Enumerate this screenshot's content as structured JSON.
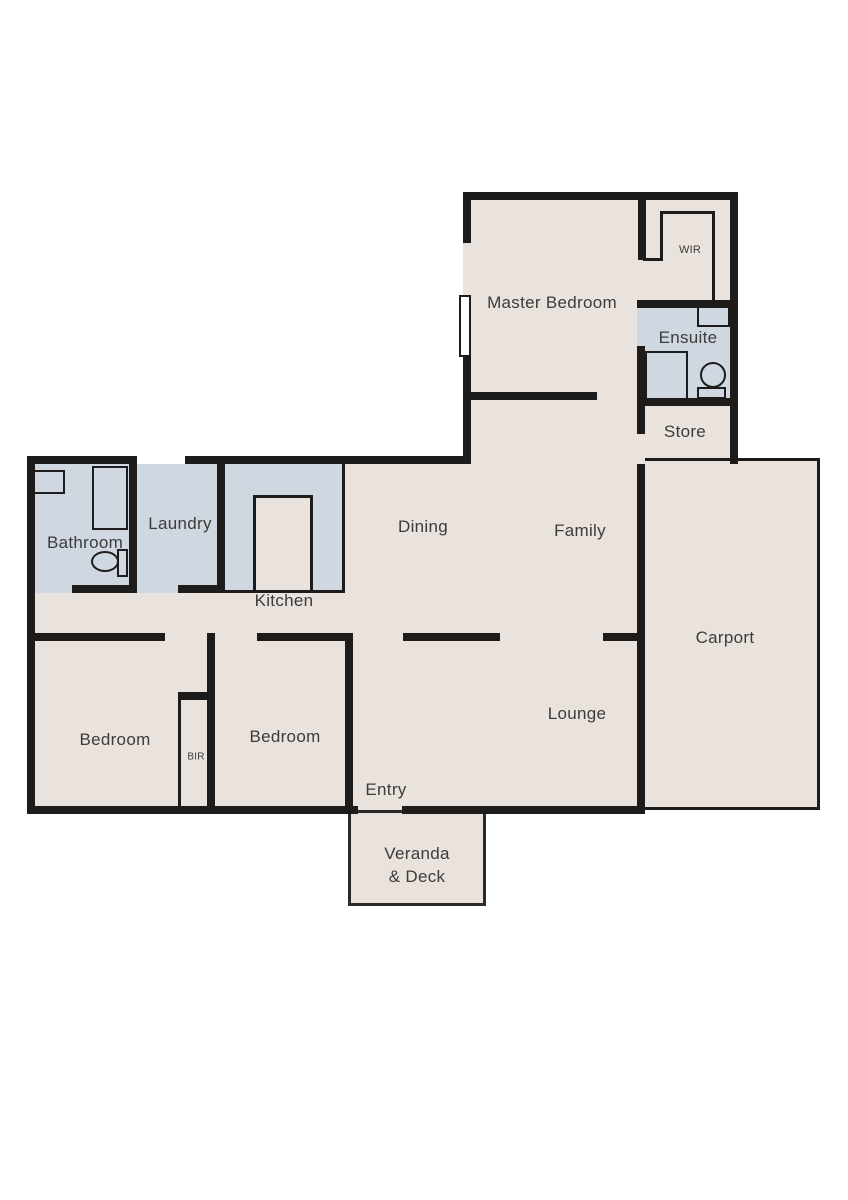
{
  "document": {
    "type": "floor-plan"
  },
  "colors": {
    "background": "#ffffff",
    "floor_fill": "#e9e2dd",
    "wet_area_fill": "#cfd7e0",
    "wall": "#1d1c1a",
    "label_text": "#3c3c3a"
  },
  "rooms": {
    "master_bedroom": {
      "label": "Master Bedroom"
    },
    "wir": {
      "label": "WIR"
    },
    "ensuite": {
      "label": "Ensuite"
    },
    "store": {
      "label": "Store"
    },
    "bathroom": {
      "label": "Bathroom"
    },
    "laundry": {
      "label": "Laundry"
    },
    "kitchen": {
      "label": "Kitchen"
    },
    "dining": {
      "label": "Dining"
    },
    "family": {
      "label": "Family"
    },
    "carport": {
      "label": "Carport"
    },
    "bedroom_left": {
      "label": "Bedroom"
    },
    "bir": {
      "label": "BIR"
    },
    "bedroom_right": {
      "label": "Bedroom"
    },
    "entry": {
      "label": "Entry"
    },
    "lounge": {
      "label": "Lounge"
    },
    "veranda": {
      "label_line1": "Veranda",
      "label_line2": "& Deck"
    }
  },
  "fixtures": [
    "toilet",
    "toilet",
    "bathtub",
    "shower",
    "basin",
    "vanity",
    "window",
    "built-in-robe",
    "walk-in-robe"
  ]
}
